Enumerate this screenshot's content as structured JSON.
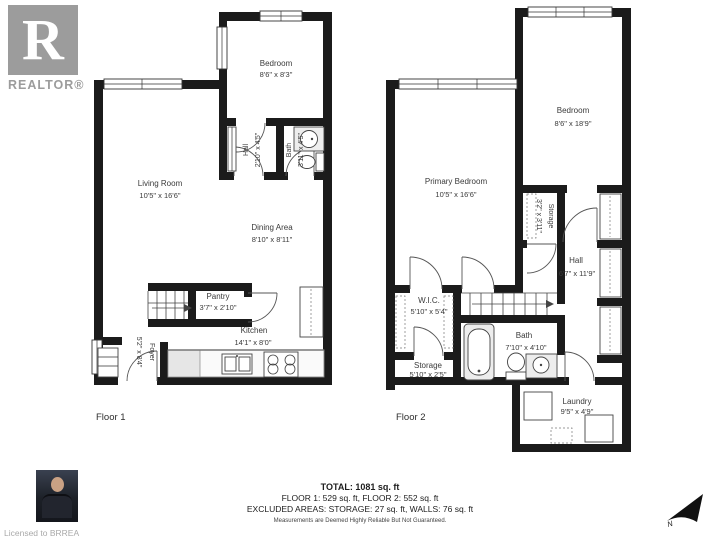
{
  "branding": {
    "logo_letter": "R",
    "logo_word": "REALTOR®",
    "licensed": "Licensed to BRREA"
  },
  "floor1": {
    "label": "Floor 1",
    "rooms": {
      "bedroom": {
        "name": "Bedroom",
        "dims": "8'6\" x 8'3\""
      },
      "hall": {
        "name": "Hall",
        "dims": "2'10\" x 4'5\""
      },
      "bath": {
        "name": "Bath",
        "dims": "3'11\" x 4'5\""
      },
      "living_room": {
        "name": "Living Room",
        "dims": "10'5\" x 16'6\""
      },
      "dining_area": {
        "name": "Dining Area",
        "dims": "8'10\" x 8'11\""
      },
      "pantry": {
        "name": "Pantry",
        "dims": "3'7\" x 2'10\""
      },
      "kitchen": {
        "name": "Kitchen",
        "dims": "14'1\" x 8'0\""
      },
      "foyer": {
        "name": "Foyer",
        "dims": "5'2\" x 8'4\""
      }
    }
  },
  "floor2": {
    "label": "Floor 2",
    "rooms": {
      "primary_bedroom": {
        "name": "Primary Bedroom",
        "dims": "10'5\" x 16'6\""
      },
      "bedroom": {
        "name": "Bedroom",
        "dims": "8'6\" x 18'9\""
      },
      "storage_upper": {
        "name": "Storage",
        "dims": "3'2\" x 3'11\""
      },
      "hall": {
        "name": "Hall",
        "dims": "6'7\" x 11'9\""
      },
      "wic": {
        "name": "W.I.C.",
        "dims": "5'10\" x 5'4\""
      },
      "storage_lower": {
        "name": "Storage",
        "dims": "5'10\" x 2'5\""
      },
      "bath": {
        "name": "Bath",
        "dims": "7'10\" x 4'10\""
      },
      "laundry": {
        "name": "Laundry",
        "dims": "9'5\" x 4'9\""
      }
    }
  },
  "summary": {
    "total": "TOTAL: 1081 sq. ft",
    "floors": "FLOOR 1: 529 sq. ft, FLOOR 2: 552 sq. ft",
    "excluded": "EXCLUDED AREAS: STORAGE: 27 sq. ft, WALLS: 76 sq. ft",
    "disclaimer": "Measurements are Deemed Highly Reliable But Not Guaranteed."
  },
  "compass": {
    "label": "N"
  }
}
